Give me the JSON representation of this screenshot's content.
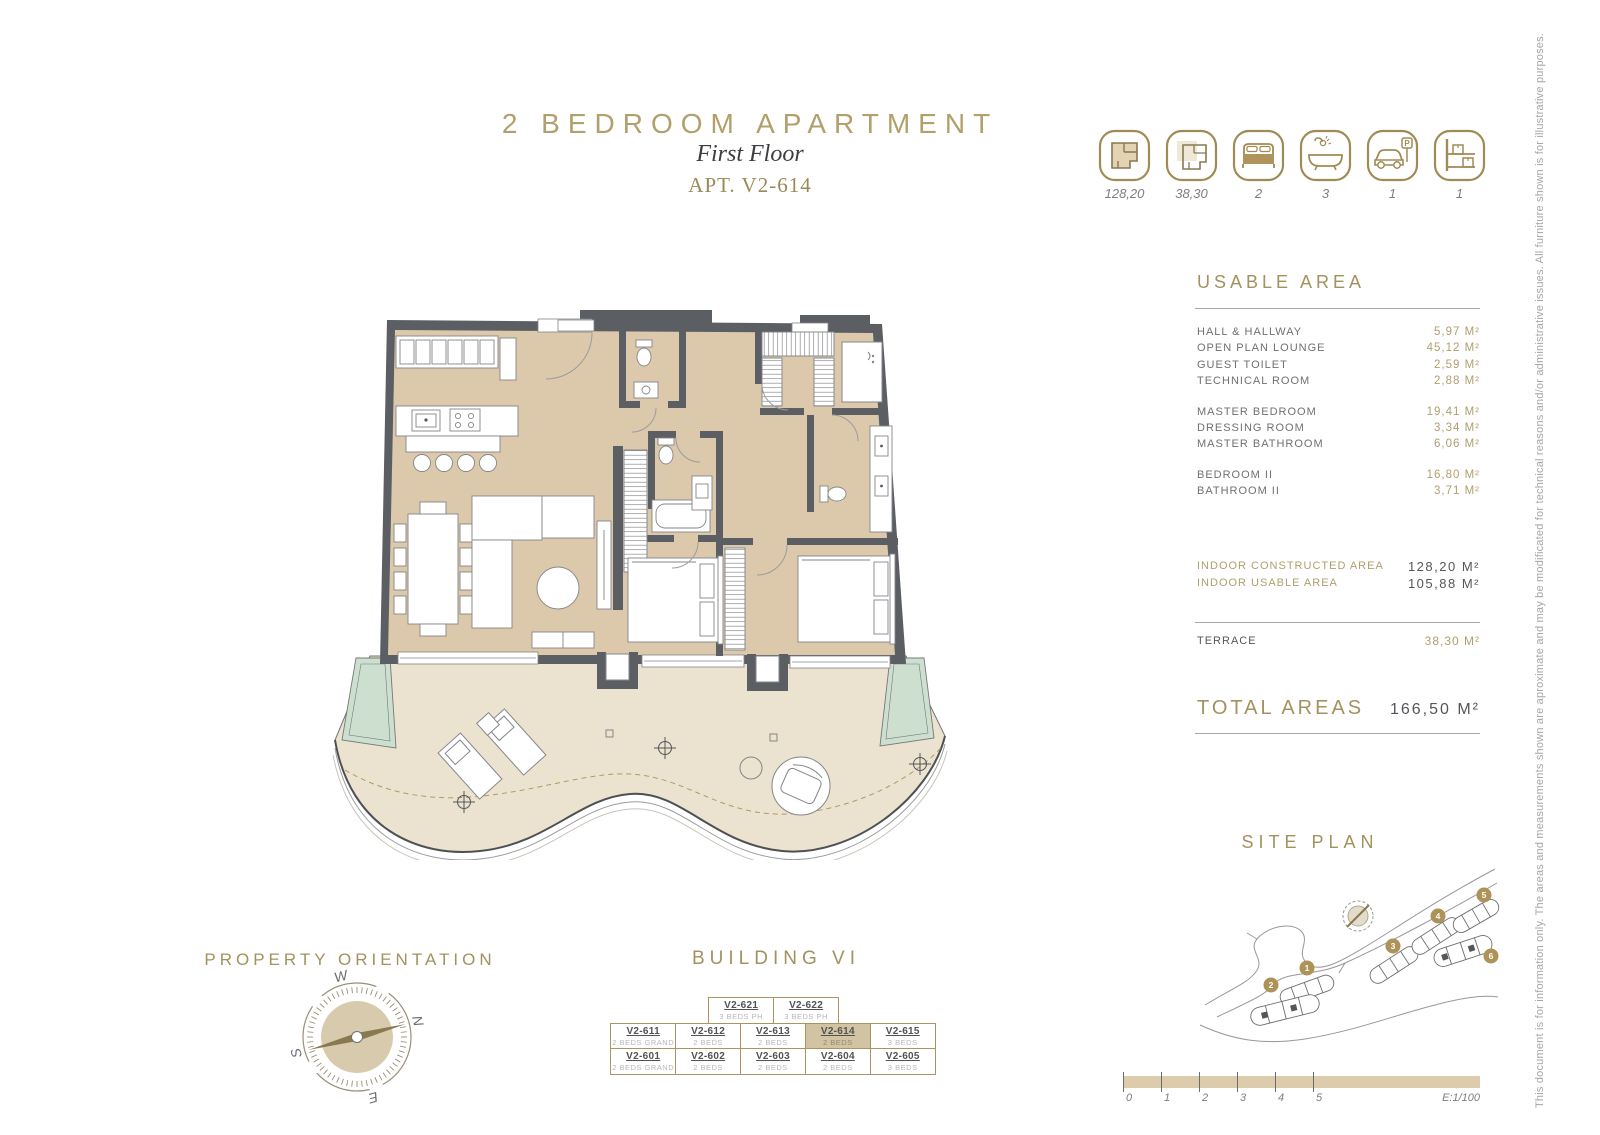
{
  "page": {
    "title": "2 BEDROOM APARTMENT",
    "floor": "First Floor",
    "apt": "APT. V2-614"
  },
  "summary": {
    "items": [
      {
        "icon": "constructed-area-icon",
        "value": "128,20"
      },
      {
        "icon": "terrace-area-icon",
        "value": "38,30"
      },
      {
        "icon": "bed-icon",
        "value": "2"
      },
      {
        "icon": "bath-icon",
        "value": "3"
      },
      {
        "icon": "parking-icon",
        "value": "1"
      },
      {
        "icon": "storage-icon",
        "value": "1"
      }
    ]
  },
  "usable_area": {
    "heading": "USABLE AREA",
    "rows": [
      {
        "label": "HALL & HALLWAY",
        "value": "5,97 M²"
      },
      {
        "label": "OPEN PLAN LOUNGE",
        "value": "45,12 M²"
      },
      {
        "label": "GUEST TOILET",
        "value": "2,59 M²"
      },
      {
        "label": "TECHNICAL ROOM",
        "value": "2,88 M²"
      },
      {
        "label": "MASTER BEDROOM",
        "value": "19,41 M²"
      },
      {
        "label": "DRESSING ROOM",
        "value": "3,34 M²"
      },
      {
        "label": "MASTER BATHROOM",
        "value": "6,06 M²"
      },
      {
        "label": "BEDROOM II",
        "value": "16,80 M²"
      },
      {
        "label": "BATHROOM II",
        "value": "3,71 M²"
      }
    ]
  },
  "areas": {
    "indoor": [
      {
        "label": "INDOOR CONSTRUCTED AREA",
        "value": "128,20 M²"
      },
      {
        "label": "INDOOR USABLE AREA",
        "value": "105,88 M²"
      }
    ],
    "terrace": {
      "label": "TERRACE",
      "value": "38,30 M²"
    },
    "total": {
      "label": "TOTAL AREAS",
      "value": "166,50 M²"
    }
  },
  "building": {
    "heading": "BUILDING VI",
    "top": [
      {
        "code": "V2-621",
        "type": "3 BEDS PH"
      },
      {
        "code": "V2-622",
        "type": "3 BEDS PH"
      }
    ],
    "rows1": [
      {
        "code": "V2-611",
        "type": "2 BEDS GRAND"
      },
      {
        "code": "V2-612",
        "type": "2 BEDS"
      },
      {
        "code": "V2-613",
        "type": "2 BEDS"
      },
      {
        "code": "V2-614",
        "type": "2 BEDS"
      },
      {
        "code": "V2-615",
        "type": "3 BEDS"
      }
    ],
    "rows2": [
      {
        "code": "V2-601",
        "type": "2 BEDS GRAND"
      },
      {
        "code": "V2-602",
        "type": "2 BEDS"
      },
      {
        "code": "V2-603",
        "type": "2 BEDS"
      },
      {
        "code": "V2-604",
        "type": "2 BEDS"
      },
      {
        "code": "V2-605",
        "type": "3 BEDS"
      }
    ]
  },
  "orientation": {
    "heading": "PROPERTY ORIENTATION",
    "n": "N",
    "e": "E",
    "s": "S",
    "w": "W"
  },
  "site_plan": {
    "heading": "SITE PLAN",
    "markers": [
      "1",
      "2",
      "3",
      "4",
      "5",
      "6"
    ]
  },
  "scale_bar": {
    "ticks": [
      "0",
      "1",
      "2",
      "3",
      "4",
      "5"
    ],
    "scale": "E:1/100"
  },
  "disclaimer": "This document is for information only. The areas and measurements shown are aproximate and may be modificated for technical reasons and/or administrative issues. All furniture shown is for illustrative purposes."
}
